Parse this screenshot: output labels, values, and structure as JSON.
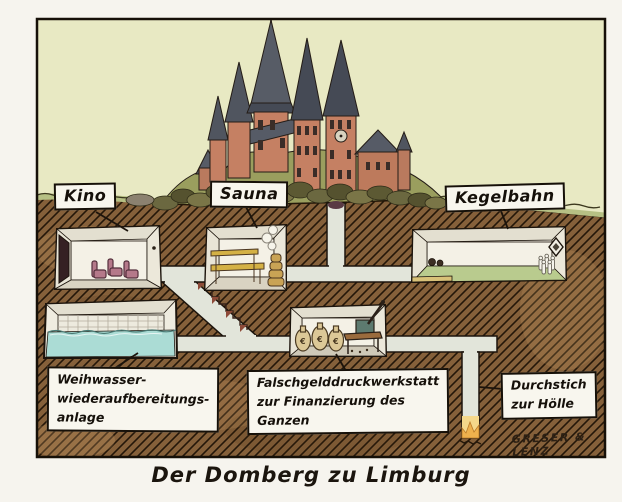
{
  "artwork": {
    "caption": "Der Domberg zu Limburg",
    "signature": "GRESER & LENZ",
    "room_labels": {
      "kino": "Kino",
      "sauna": "Sauna",
      "kegelbahn": "Kegelbahn"
    },
    "annotation_labels": {
      "weihwasser": {
        "lines": [
          "Weihwasser-",
          "wiederaufbereitungs-",
          "anlage"
        ]
      },
      "falschgeld": {
        "lines": [
          "Falschgelddruckwerkstatt",
          "zur Finanzierung des",
          "Ganzen"
        ]
      },
      "hoelle": {
        "lines": [
          "Durchstich",
          "zur Hölle"
        ]
      }
    },
    "money_bag_symbol": "€",
    "colors": {
      "paper": "#f6f4ee",
      "sky": "#e8e9c3",
      "earth": "#85603a",
      "earth_hatch": "#241709",
      "grass": "#b6c084",
      "hill": "#9a9e5e",
      "corridor": "#e2e5da",
      "water": "#abdcd5",
      "lane": "#b9cb8e",
      "seat_red": "#b5798a",
      "bench_wood": "#d4b145",
      "money_bag": "#dcc897",
      "hell_glow": "#eeb14d",
      "cathedral_wall": "#c58063",
      "cathedral_roof": "#50555f",
      "label_bg": "#f8f6ee",
      "ink": "#15100a"
    }
  }
}
